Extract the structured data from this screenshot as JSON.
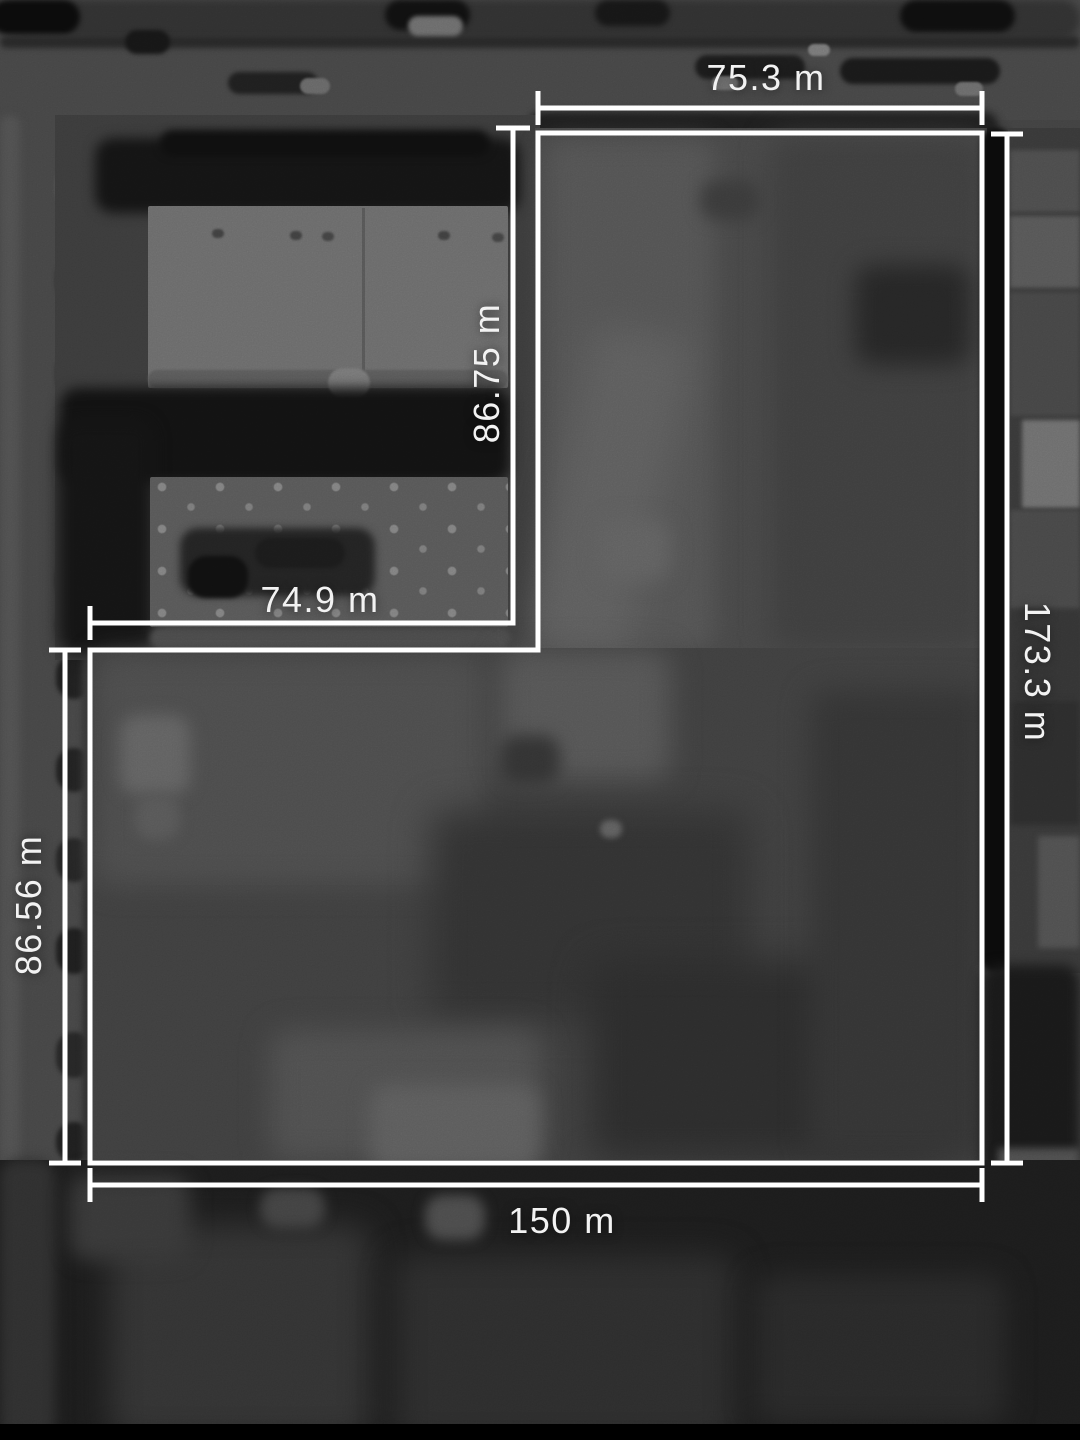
{
  "overlay": {
    "line_color": "#ffffff",
    "text_color": "#f2f2f2"
  },
  "measurements": {
    "top": {
      "label": "75.3 m",
      "value": 75.3,
      "unit": "m"
    },
    "inner_vertical": {
      "label": "86.75 m",
      "value": 86.75,
      "unit": "m"
    },
    "inner_horizontal": {
      "label": "74.9 m",
      "value": 74.9,
      "unit": "m"
    },
    "right": {
      "label": "173.3 m",
      "value": 173.3,
      "unit": "m"
    },
    "left": {
      "label": "86.56 m",
      "value": 86.56,
      "unit": "m"
    },
    "bottom": {
      "label": "150 m",
      "value": 150,
      "unit": "m"
    }
  }
}
